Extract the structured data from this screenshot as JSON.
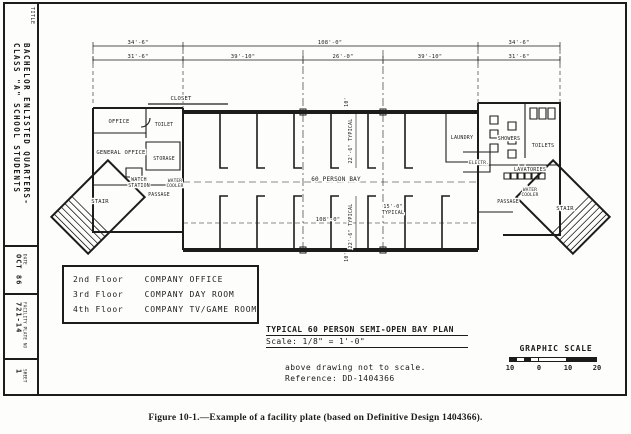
{
  "colors": {
    "ink": "#1c1c1c",
    "paper": "#fdfdfb"
  },
  "figure_caption": "Figure 10-1.—Example of a facility plate (based on Definitive Design 1404366).",
  "title_block": {
    "title_label": "TITLE",
    "title_line1": "BACHELOR ENLISTED QUARTERS-",
    "title_line2": "CLASS \"A\" SCHOOL STUDENTS",
    "date_label": "DATE",
    "date_value": "OCT 86",
    "plate_label": "FACILITY PLATE NO",
    "plate_value": "721-14",
    "sheet_label": "SHEET",
    "sheet_value": "1"
  },
  "floor_table": {
    "rows": [
      {
        "floor": "2nd Floor",
        "use": "COMPANY OFFICE"
      },
      {
        "floor": "3rd Floor",
        "use": "COMPANY DAY ROOM"
      },
      {
        "floor": "4th Floor",
        "use": "COMPANY TV/GAME ROOM"
      }
    ]
  },
  "plan_title": {
    "title": "TYPICAL 60 PERSON SEMI-OPEN BAY PLAN",
    "scale": "Scale:  1/8\" = 1'-0\"",
    "note1": "above drawing not to scale.",
    "note2": "Reference: DD-1404366"
  },
  "graphic_scale": {
    "label": "GRAPHIC SCALE",
    "ticks": [
      "10",
      "0",
      "10",
      "20"
    ]
  },
  "plan": {
    "dims": {
      "top_left": "34'-6\"",
      "top_mid": "108'-0\"",
      "top_right": "34'-6\"",
      "row2_1": "31'-6\"",
      "row2_2": "39'-10\"",
      "row2_3": "26'-0\"",
      "row2_4": "39'-10\"",
      "row2_5": "31'-6\"",
      "bay_width": "108'-0\"",
      "bay_depth": "22'-6\" TYPICAL",
      "typ_w1": "15'-0\"",
      "typ_w2": "TYPICAL",
      "ten": "10'"
    },
    "labels": {
      "closet": "CLOSET",
      "office": "OFFICE",
      "toilet": "TOILET",
      "general_office": "GENERAL OFFICE",
      "storage": "STORAGE",
      "watch1": "WATCH",
      "watch2": "STATION",
      "coolerL1": "WATER",
      "coolerL2": "COOLER",
      "passage_left": "PASSAGE",
      "stair_left": "STAIR",
      "bay": "60 PERSON BAY",
      "laundry": "LAUNDRY",
      "showers": "SHOWERS",
      "toilets": "TOILETS",
      "electrical": "ELECTR.",
      "lavatories": "LAVATORIES",
      "coolerR1": "WATER",
      "coolerR2": "COOLER",
      "passage_right": "PASSAGE",
      "stair_right": "STAIR"
    }
  }
}
